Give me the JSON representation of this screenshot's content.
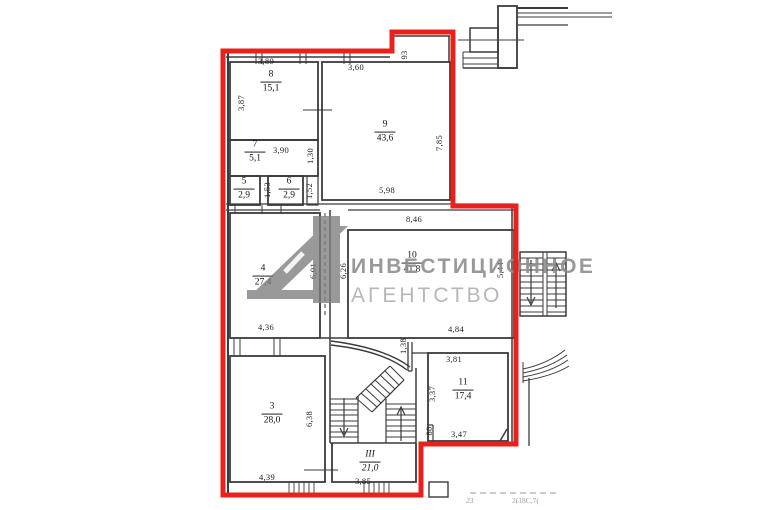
{
  "watermark": {
    "line1": "ИНВЕСТИЦИОННОЕ",
    "line2": "АГЕНТСТВО"
  },
  "colors": {
    "outline": "#e8211c",
    "wall": "#3b3b3b",
    "watermark_gray": "#8f8f8f"
  },
  "rooms": [
    {
      "num": "8",
      "area": "15,1"
    },
    {
      "num": "9",
      "area": "43,6"
    },
    {
      "num": "7",
      "area": "5,1"
    },
    {
      "num": "5",
      "area": "2,9"
    },
    {
      "num": "6",
      "area": "2,9"
    },
    {
      "num": "4",
      "area": "27,4"
    },
    {
      "num": "10",
      "area": "41,8"
    },
    {
      "num": "3",
      "area": "28,0"
    },
    {
      "num": "11",
      "area": "17,4"
    },
    {
      "num": "III",
      "area": "21,0"
    }
  ],
  "dims": [
    {
      "label": "3,89"
    },
    {
      "label": "3,60"
    },
    {
      "label": "5,98"
    },
    {
      "label": "3,90"
    },
    {
      "label": "8,46"
    },
    {
      "label": "4,36"
    },
    {
      "label": "4,84"
    },
    {
      "label": "3,81"
    },
    {
      "label": "3,47"
    },
    {
      "label": "4,39"
    },
    {
      "label": "3,85"
    },
    {
      "label": "3,87"
    },
    {
      "label": "93"
    },
    {
      "label": "7,85"
    },
    {
      "label": "1,30"
    },
    {
      "label": "1,53"
    },
    {
      "label": "1,52"
    },
    {
      "label": "6,01"
    },
    {
      "label": "6,26"
    },
    {
      "label": "5,44"
    },
    {
      "label": "1,38"
    },
    {
      "label": "3,37"
    },
    {
      "label": "80"
    },
    {
      "label": "6,38"
    }
  ],
  "footer": {
    "mark": "23",
    "code": "2(18С,7("
  }
}
